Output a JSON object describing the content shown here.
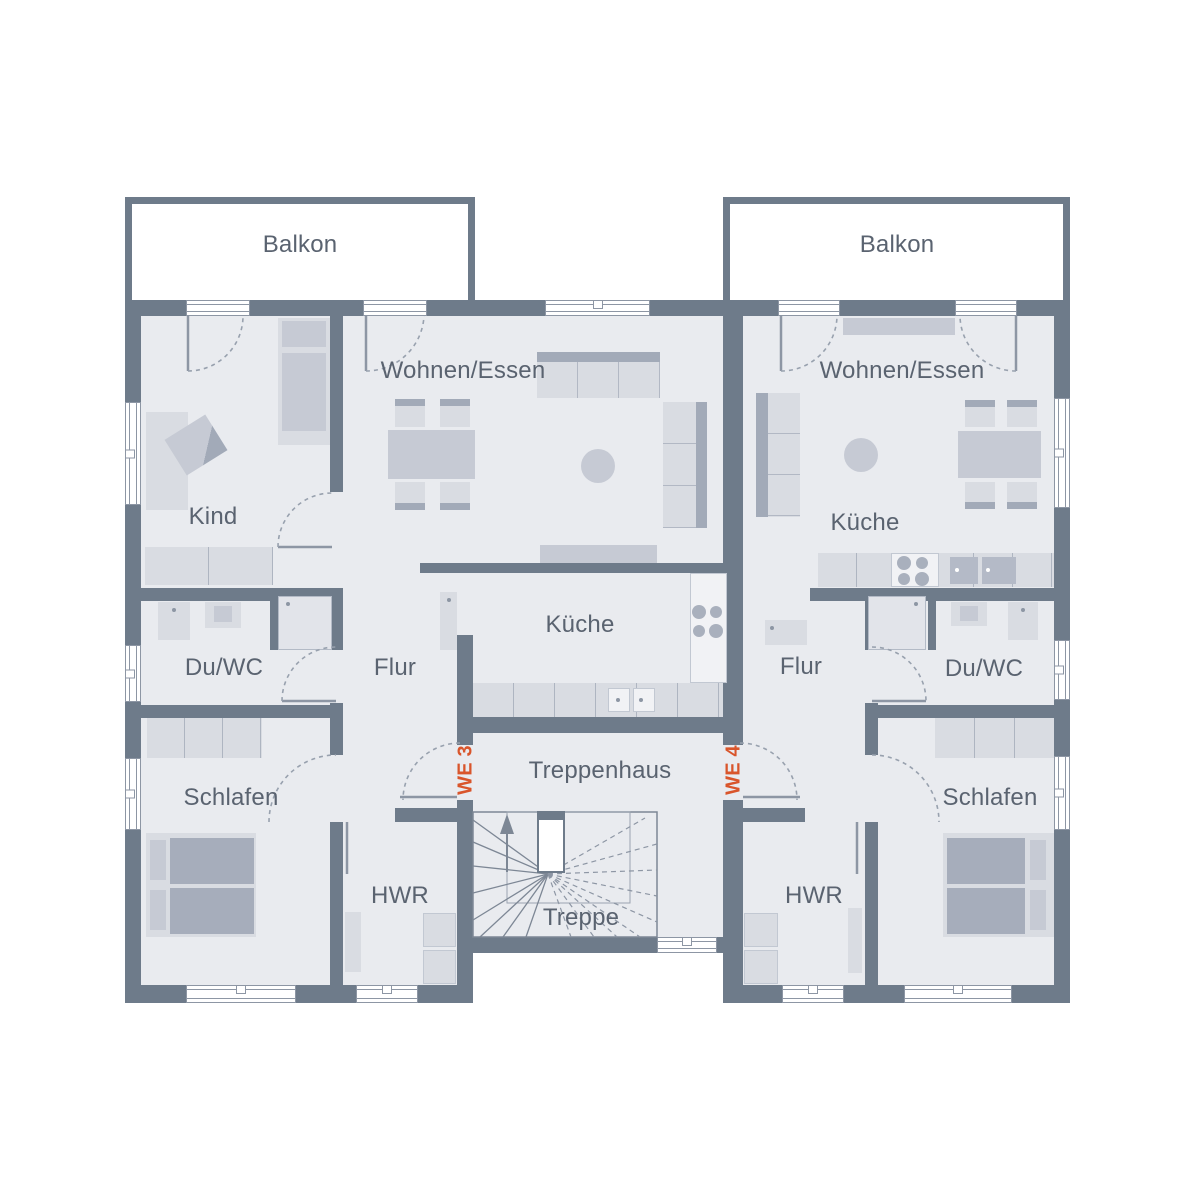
{
  "floorplan": {
    "balcony_left_label": "Balkon",
    "balcony_right_label": "Balkon",
    "stairwell": {
      "hall_label": "Treppenhaus",
      "stairs_label": "Treppe"
    },
    "unit_left": {
      "id_label": "WE 3",
      "rooms": {
        "kind": "Kind",
        "wohnen_essen": "Wohnen/Essen",
        "kueche": "Küche",
        "du_wc": "Du/WC",
        "flur": "Flur",
        "schlafen": "Schlafen",
        "hwr": "HWR"
      }
    },
    "unit_right": {
      "id_label": "WE 4",
      "rooms": {
        "wohnen_essen": "Wohnen/Essen",
        "kueche": "Küche",
        "du_wc": "Du/WC",
        "flur": "Flur",
        "schlafen": "Schlafen",
        "hwr": "HWR"
      }
    },
    "colors": {
      "wall": "#6e7b8a",
      "floor": "#e9ebef",
      "accent": "#d9552b"
    }
  }
}
